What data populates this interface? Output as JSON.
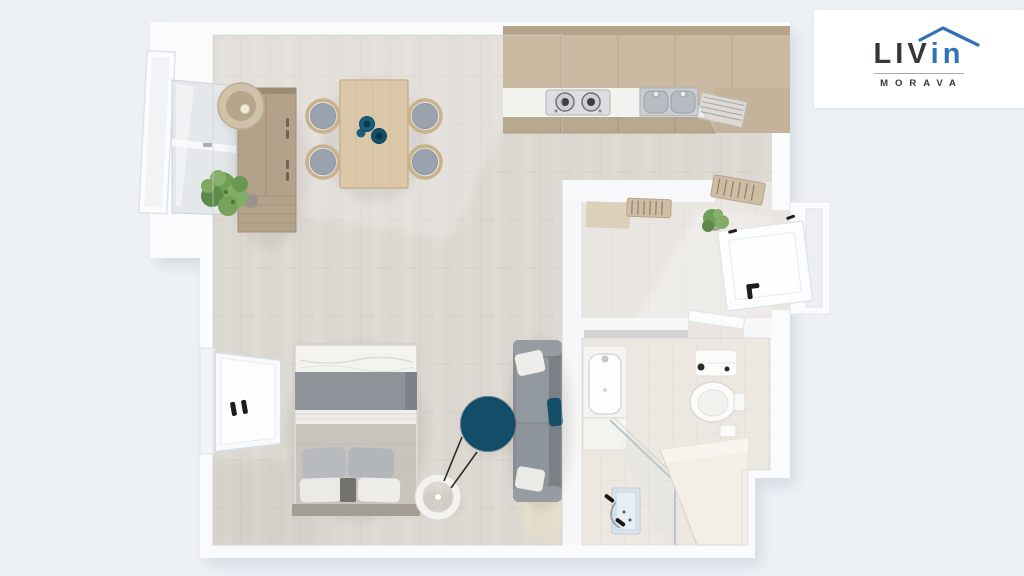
{
  "meta": {
    "width": 1024,
    "height": 576,
    "background": "#edf1f5",
    "description": "3D top-down rendering of a studio apartment floor plan"
  },
  "logo": {
    "brand_dark": "LIV",
    "brand_accent": "in",
    "subtext": "MORAVA",
    "accent_color": "#2f73b6",
    "text_color": "#34373c"
  },
  "floorplan": {
    "view": "top-down-3d-render",
    "rooms": [
      "living-room-with-bed",
      "open-kitchen",
      "hallway",
      "bathroom"
    ],
    "furniture": {
      "living": [
        "wardrobe",
        "table-lamp",
        "potted-plant",
        "dining-table",
        "four-dining-chairs",
        "teal-bowls",
        "double-bed",
        "sofa",
        "teal-accent-pillow",
        "round-teal-rug",
        "ring-floor-lamp"
      ],
      "kitchen": [
        "beige-cabinets",
        "white-countertop",
        "two-burner-stove",
        "double-sink",
        "dish-rack"
      ],
      "hallway": [
        "doormat",
        "radiator-grille",
        "radiator-grille",
        "potted-plant",
        "entry-door-open"
      ],
      "bathroom": [
        "mirror-shelf",
        "vanity-washbasin",
        "toilet",
        "shower-glass-screen",
        "shower-fixture",
        "bench",
        "bathroom-door"
      ]
    },
    "windows": [
      "upper-left-window-with-open-shutter",
      "lower-left-window"
    ],
    "colors": {
      "wall": "#fafbfc",
      "floor_living": "#dbd7d1",
      "floor_hallway": "#e9e6e2",
      "floor_bathroom": "#ece7e0",
      "kitchen_beige": "#c9b9a1",
      "wood_light": "#dac8a8",
      "wood_medium": "#b4a18a",
      "upholstery_gray": "#888d94",
      "bed_blanket_gray": "#8e939a",
      "accent_teal": "#134e69",
      "plant_green": "#6f9e55"
    }
  }
}
